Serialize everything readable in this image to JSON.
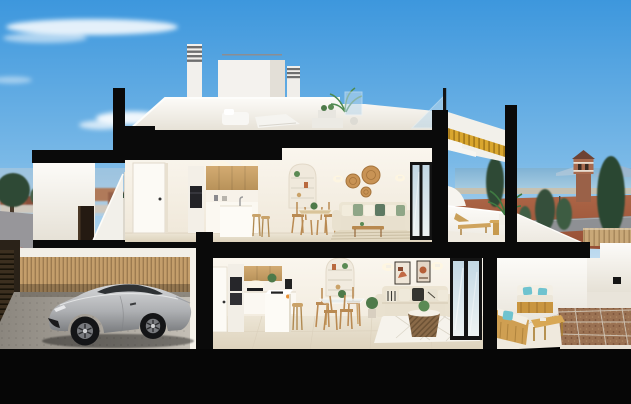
{
  "scene": {
    "type": "architectural-cross-section-render",
    "description": "Photorealistic cutaway render of a two-storey coastal townhouse. Black cut planes frame the section. Upper floor: open kitchen with timber upper cabinets, white island with stools, arched shelving niche, dining set, cream sofa with green cushions, woven wall baskets, and a private terrace with a sun lounger and potted palm. Ground floor: garage with a silver sports coupe behind a timber-slat wall, second kitchen with island, glass dining table, living room with cream sofa, abstract art frames, rattan basket coffee table and sliding glass doors onto a terrace with a timber outdoor lounge set with teal cushions and a gravel patio. Rooftop solarium with white loungers, chimneys and glass balustrade. Background: blue sky with wispy clouds, distant town on the left, sea horizon, conifers and a historic watchtower on the right.",
    "labels": {
      "sky": "blue sky with wispy clouds",
      "town": "distant town and trees (left background)",
      "street": "street with red pavement (left)",
      "sea": "sea horizon with distant mountains",
      "watchtower": "historic stone watchtower",
      "conifers": "dark conifer trees",
      "dirt": "terracotta ground and coastal road",
      "rooftop": "rooftop solarium with white loungers and chimneys",
      "upper_floor": "upper floor: kitchen, dining, living room",
      "upper_terrace": "upper terrace with sun lounger and palm",
      "staircase": "cutaway staircase with golden timber soffit",
      "entry": "exterior entry stairs and doorway",
      "garage": "garage with silver sports coupe",
      "ground_floor": "ground floor: kitchen, dining, living room",
      "ground_terrace": "ground terrace with timber lounge set",
      "neighbor": "neighbouring white terrace volume",
      "cut_planes": "black section cut planes",
      "car": "silver sports coupe",
      "slat_wall": "timber slat garage wall",
      "sliding_doors": "black-framed sliding glass doors"
    },
    "levels": [
      {
        "name": "rooftop",
        "objects": [
          "louvered chimney",
          "second chimney",
          "penthouse volume",
          "white outdoor sofa",
          "white sun loungers",
          "planter table",
          "potted palm",
          "glass balustrade"
        ]
      },
      {
        "name": "upper floor",
        "rooms": [
          {
            "name": "kitchen",
            "objects": [
              "white interior door",
              "tall oven column",
              "timber upper cabinets",
              "white base cabinets",
              "white island with faucet",
              "two timber stools"
            ]
          },
          {
            "name": "dining",
            "objects": [
              "arched shelf niche",
              "round table",
              "four timber chairs",
              "green centerpiece"
            ]
          },
          {
            "name": "living",
            "objects": [
              "cream three-seat sofa",
              "green and cream cushions",
              "three woven wall baskets",
              "two wall sconces",
              "timber coffee table",
              "striped rug",
              "sliding glass doors"
            ]
          },
          {
            "name": "terrace",
            "objects": [
              "timber sun lounger",
              "round side table",
              "potted palm",
              "white parapet"
            ]
          }
        ]
      },
      {
        "name": "ground floor",
        "rooms": [
          {
            "name": "garage",
            "objects": [
              "silver sports coupe",
              "timber slat wall",
              "dark entry gate",
              "concrete floor"
            ]
          },
          {
            "name": "kitchen",
            "objects": [
              "white door",
              "stacked ovens column",
              "timber upper cabinets",
              "black cooktop",
              "white island with hob",
              "fruit bowl",
              "timber stool",
              "coffee machine"
            ]
          },
          {
            "name": "dining",
            "objects": [
              "arched shelf niche",
              "glass round table",
              "four timber chairs"
            ]
          },
          {
            "name": "living",
            "objects": [
              "cream sofa with patterned cushions",
              "two abstract art frames",
              "two wall sconces",
              "rattan basket coffee table",
              "white diamond rug",
              "potted plant",
              "sliding glass doors"
            ]
          },
          {
            "name": "terrace",
            "objects": [
              "timber outdoor sofa",
              "teal cushions",
              "timber chaise",
              "slatted coffee table",
              "gravel patio with shadow grid",
              "white perimeter walls"
            ]
          }
        ]
      }
    ],
    "background": [
      "wispy clouds",
      "distant town rooftops",
      "white apartment block",
      "round street trees",
      "grey road",
      "red pavement",
      "sea with mountains",
      "beach strip",
      "watchtower",
      "timber fence",
      "light poles",
      "conifer trees",
      "terracotta ground"
    ]
  },
  "colors": {
    "sky_top": "#3d97dd",
    "sky_mid": "#7ab9e7",
    "sky_horizon": "#c3ddf0",
    "cut_black": "#0a0a0a",
    "foundation_black": "#060606",
    "interior_wall": "#faf6ee",
    "interior_wall_deep": "#efe7d8",
    "roof_white": "#fcfbf8",
    "roof_white_deep": "#e6e1d6",
    "cabinet_wood": "#d3ab72",
    "cabinet_wood_deep": "#b8925a",
    "stair_gold": "#d9a62e",
    "stair_gold_deep": "#b07f17",
    "car_silver_light": "#d6d7d9",
    "car_silver_dark": "#797b7e",
    "sea_blue": "#7fb2d4",
    "sea_blue_light": "#a9cde2",
    "terracotta_ground": "#ac6546",
    "terracotta_deep": "#964f35",
    "tree_green": "#2f4a36",
    "teal_cushion": "#6fc3cf",
    "outdoor_wood": "#c9953f",
    "slat_wood": "#c49e6b",
    "sofa_cream": "#e8e0ce",
    "floor_beige": "#ece5d5",
    "garage_floor_light": "#c6c1b8",
    "garage_floor_dark": "#8b867e",
    "glass_reflection": "#c3d8e4",
    "rug_stripe": "#e3d9c2"
  }
}
